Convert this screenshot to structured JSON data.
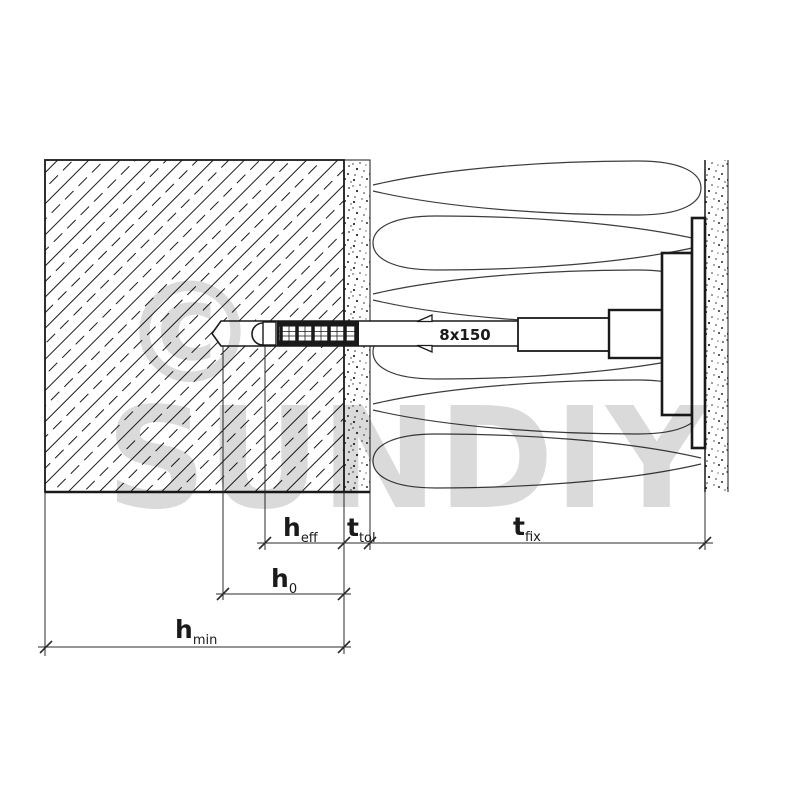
{
  "diagram": {
    "title": "anchor-installation-cross-section",
    "anchor": {
      "size_label": "8x150"
    },
    "dimensions": {
      "h_eff": {
        "main": "h",
        "sub": "eff"
      },
      "t_tol": {
        "main": "t",
        "sub": "tol"
      },
      "t_fix": {
        "main": "t",
        "sub": "fix"
      },
      "h_0": {
        "main": "h",
        "sub": "0"
      },
      "h_min": {
        "main": "h",
        "sub": "min"
      }
    },
    "watermark": {
      "symbol": "©",
      "brand": "SUNDIY"
    },
    "colors": {
      "line": "#1a1a1a",
      "dimension": "#2b2b2b",
      "watermark": "#dadada",
      "background": "#ffffff"
    }
  }
}
